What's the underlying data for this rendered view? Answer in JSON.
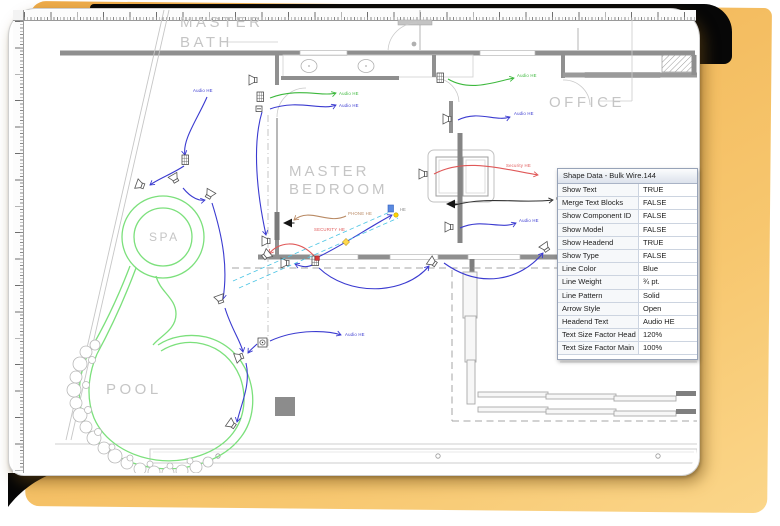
{
  "backdrop": {
    "color_top": "#eeab49",
    "color_bottom": "#fbd68a",
    "backing_color": "#070707"
  },
  "rooms": {
    "master_bath": {
      "line1": "MASTER",
      "line2": "BATH"
    },
    "master_bedroom": {
      "line1": "MASTER",
      "line2": "BEDROOM"
    },
    "office": {
      "label": "OFFICE"
    },
    "spa": {
      "label": "SPA"
    },
    "pool": {
      "label": "POOL"
    }
  },
  "selection": {
    "end_label": "HE",
    "handle_color": "#ffd84d",
    "begin_color": "#d83a3a",
    "outline_color": "#4ac4e4"
  },
  "drawing": {
    "wires": [
      {
        "color": "#3a3ad0",
        "d": "M207,97 C198,118 182,140 185,155",
        "label": "Audio HE",
        "lx": 193,
        "ly": 92
      },
      {
        "color": "#3a3ad0",
        "d": "M184,166 C172,174 158,179 150,185"
      },
      {
        "color": "#3a3ad0",
        "d": "M183,188 C192,199 200,201 205,200"
      },
      {
        "color": "#3a3ad0",
        "d": "M212,203 C223,238 228,268 223,299"
      },
      {
        "color": "#3a3ad0",
        "d": "M225,308 C231,328 241,342 243,352"
      },
      {
        "color": "#3a3ad0",
        "d": "M246,363 C251,385 241,404 237,422"
      },
      {
        "color": "#3a3ad0",
        "d": "M257,344 C253,348 250,350 248,353"
      },
      {
        "color": "#3a3ad0",
        "d": "M270,341 C298,328 330,331 341,335",
        "label": "Audio HE",
        "lx": 345,
        "ly": 336
      },
      {
        "color": "#3a3ad0",
        "d": "M262,112 C252,145 257,194 266,235"
      },
      {
        "color": "#3a3ad0",
        "d": "M270,109 C298,99 322,111 336,105",
        "label": "Audio HE",
        "lx": 339,
        "ly": 107
      },
      {
        "color": "#3cb83c",
        "d": "M270,98 C298,87 322,97 336,93",
        "label": "Audio HE",
        "lx": 339,
        "ly": 95
      },
      {
        "color": "#3cb83c",
        "d": "M448,79 C470,92 494,82 514,78",
        "label": "Audio HE",
        "lx": 517,
        "ly": 77
      },
      {
        "color": "#3a3ad0",
        "d": "M458,120 C478,110 496,122 510,117",
        "label": "Audio HE",
        "lx": 514,
        "ly": 115
      },
      {
        "color": "#3a3ad0",
        "d": "M460,228 C482,218 500,230 516,223",
        "label": "Audio HE",
        "lx": 519,
        "ly": 222
      },
      {
        "color": "#e05858",
        "d": "M434,174 C464,158 498,168 538,175",
        "label": "Security HE",
        "lx": 506,
        "ly": 167
      },
      {
        "color": "#303030",
        "d": "M455,205 C488,196 520,204 553,200",
        "label": "CATV HE",
        "lx": 556,
        "ly": 200
      },
      {
        "color": "#b98a64",
        "d": "M346,216 C328,225 310,207 294,220",
        "label": "PHONE HE",
        "lx": 348,
        "ly": 215
      },
      {
        "color": "#e05858",
        "d": "M316,258 C298,237 277,243 269,254",
        "label": "SECURITY HE",
        "lx": 314,
        "ly": 231
      },
      {
        "color": "#3a3ad0",
        "d": "M319,268 C348,296 404,296 429,266"
      },
      {
        "color": "#3a3ad0",
        "d": "M444,263 C480,289 520,281 543,253"
      },
      {
        "color": "#3a3ad0",
        "d": "M318,257 C340,247 371,226 392,215"
      },
      {
        "color": "#3a3ad0",
        "d": "M607,270 C628,260 646,277 663,266",
        "label": "Audio HE",
        "lx": 628,
        "ly": 255
      },
      {
        "color": "#303030",
        "d": "M599,191 C615,183 631,189 645,185"
      },
      {
        "color": "#3a3ad0",
        "d": "M314,264 C308,268 302,267 295,264"
      }
    ],
    "devices": [
      {
        "type": "keypad",
        "x": 182,
        "y": 155,
        "rot": 0
      },
      {
        "type": "keypad",
        "x": 312,
        "y": 256,
        "rot": 0
      },
      {
        "type": "keypad",
        "x": 437,
        "y": 73,
        "rot": 0
      },
      {
        "type": "keypad",
        "x": 257,
        "y": 92,
        "rot": 0
      },
      {
        "type": "outlet",
        "x": 256,
        "y": 106,
        "rot": 0
      },
      {
        "type": "horn",
        "x": 143,
        "y": 186,
        "rot": 200
      },
      {
        "type": "horn",
        "x": 176,
        "y": 181,
        "rot": 240
      },
      {
        "type": "horn",
        "x": 208,
        "y": 197,
        "rot": 300
      },
      {
        "type": "horn",
        "x": 269,
        "y": 241,
        "rot": 180
      },
      {
        "type": "horn",
        "x": 288,
        "y": 263,
        "rot": 180
      },
      {
        "type": "horn",
        "x": 435,
        "y": 264,
        "rot": 215
      },
      {
        "type": "horn",
        "x": 547,
        "y": 250,
        "rot": 235
      },
      {
        "type": "horn",
        "x": 450,
        "y": 119,
        "rot": 180
      },
      {
        "type": "horn",
        "x": 452,
        "y": 227,
        "rot": 180
      },
      {
        "type": "horn",
        "x": 426,
        "y": 174,
        "rot": 180
      },
      {
        "type": "horn",
        "x": 600,
        "y": 270,
        "rot": 0
      },
      {
        "type": "horn",
        "x": 221,
        "y": 302,
        "rot": 250
      },
      {
        "type": "horn",
        "x": 242,
        "y": 356,
        "rot": 160
      },
      {
        "type": "horn",
        "x": 234,
        "y": 426,
        "rot": 215
      },
      {
        "type": "horn",
        "x": 256,
        "y": 80,
        "rot": 180
      },
      {
        "type": "horn",
        "x": 264,
        "y": 257,
        "rot": -40
      },
      {
        "type": "speaker-filled",
        "x": 283,
        "y": 223,
        "rot": 0
      },
      {
        "type": "speaker-filled",
        "x": 446,
        "y": 204,
        "rot": 0
      },
      {
        "type": "speaker-filled",
        "x": 591,
        "y": 192,
        "rot": 0
      },
      {
        "type": "volume",
        "x": 258,
        "y": 338,
        "rot": 0
      }
    ]
  },
  "panel": {
    "title": "Shape Data - Bulk Wire.144",
    "rows": [
      {
        "label": "Show Text",
        "value": "TRUE"
      },
      {
        "label": "Merge Text Blocks",
        "value": "FALSE"
      },
      {
        "label": "Show Component ID",
        "value": "FALSE"
      },
      {
        "label": "Show Model",
        "value": "FALSE"
      },
      {
        "label": "Show Headend",
        "value": "TRUE"
      },
      {
        "label": "Show Type",
        "value": "FALSE"
      },
      {
        "label": "Line Color",
        "value": "Blue"
      },
      {
        "label": "Line Weight",
        "value": "¾ pt."
      },
      {
        "label": "Line Pattern",
        "value": "Solid"
      },
      {
        "label": "Arrow Style",
        "value": "Open"
      },
      {
        "label": "Headend Text",
        "value": "Audio HE"
      },
      {
        "label": "Text Size Factor Head End",
        "value": "120%"
      },
      {
        "label": "Text Size Factor Main",
        "value": "100%"
      }
    ]
  }
}
